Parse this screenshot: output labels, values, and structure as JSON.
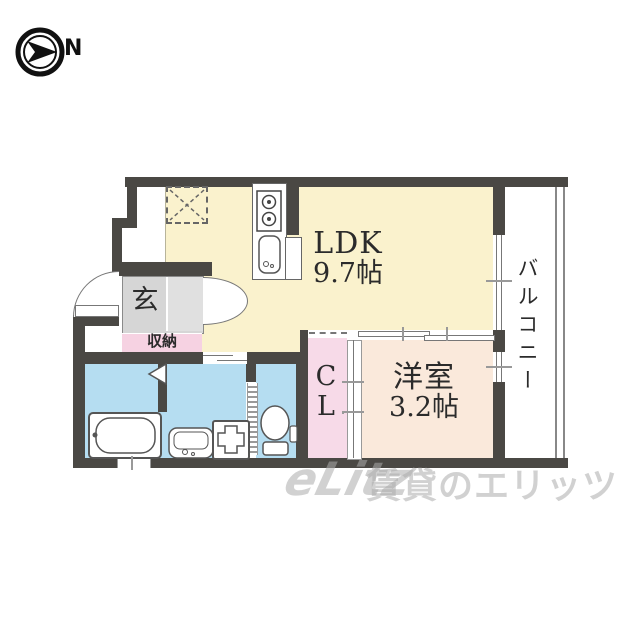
{
  "compass": {
    "label": "N"
  },
  "rooms": {
    "ldk": {
      "name": "LDK",
      "size": "9.7帖"
    },
    "western_room": {
      "name": "洋室",
      "size": "3.2帖"
    },
    "entrance": {
      "label": "玄"
    },
    "storage": {
      "label": "収納"
    },
    "closet": {
      "char1": "C",
      "char2": "L"
    },
    "balcony": {
      "label": "バルコニー"
    }
  },
  "fixtures": {
    "kitchen": [
      "stove-icon",
      "sink-icon",
      "refrigerator-space-icon"
    ],
    "sanitary": [
      "bathtub-icon",
      "bath-folding-door-icon",
      "washbasin-icon",
      "washing-machine-pan-icon",
      "toilet-icon"
    ],
    "doors": [
      "entrance-door-arc",
      "hall-door-arc",
      "sliding-door",
      "closet-sliding-door",
      "toilet-accordion-door"
    ]
  },
  "watermark": {
    "logo": "eLitz",
    "text": "賃貸のエリッツ"
  },
  "colors": {
    "wall": "#4a4844",
    "ldk_floor": "#faf2cd",
    "western_floor": "#fae9db",
    "wet_area_floor": "#b5ddf1",
    "storage_pink": "#f6d2e2",
    "closet_pink": "#f7dae8",
    "entrance_gray": "#d6d6d6",
    "watermark_gray": "#acacac"
  }
}
